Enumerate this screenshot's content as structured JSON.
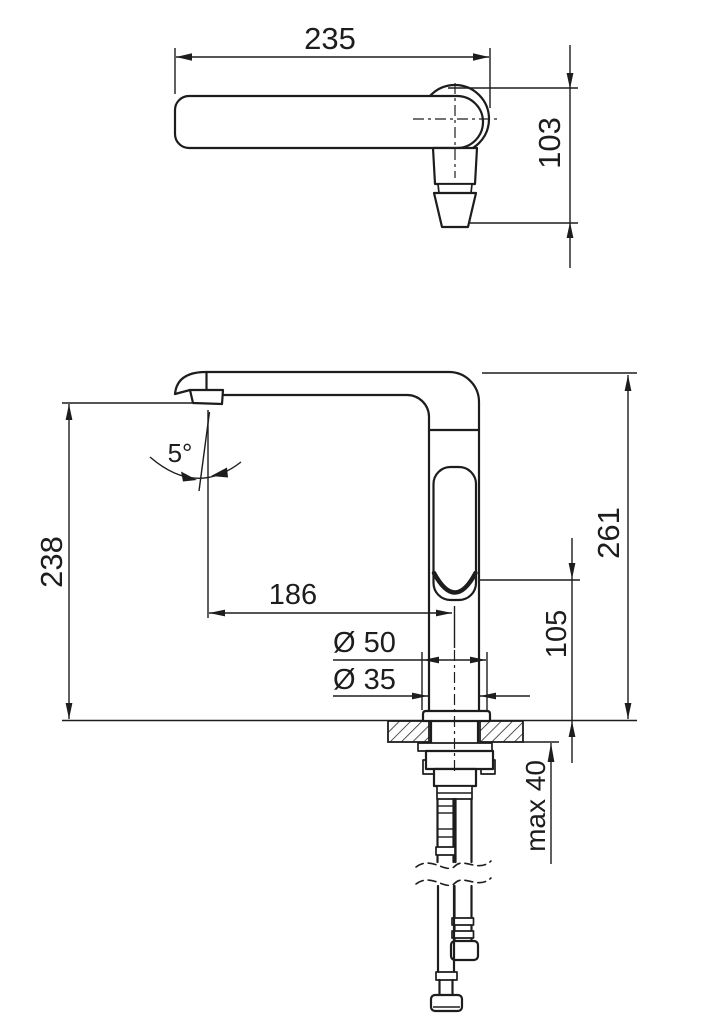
{
  "page": {
    "background": "#ffffff",
    "ink": "#1d1d1d"
  },
  "views": {
    "top": {
      "dims": {
        "width": "235",
        "height": "103"
      }
    },
    "front": {
      "dims": {
        "spout_height": "238",
        "angle": "5°",
        "reach": "186",
        "base_diameter": "Ø 50",
        "thread_diameter": "Ø 35",
        "total_height": "261",
        "outlet_height": "105",
        "max_counter": "max 40"
      }
    }
  }
}
